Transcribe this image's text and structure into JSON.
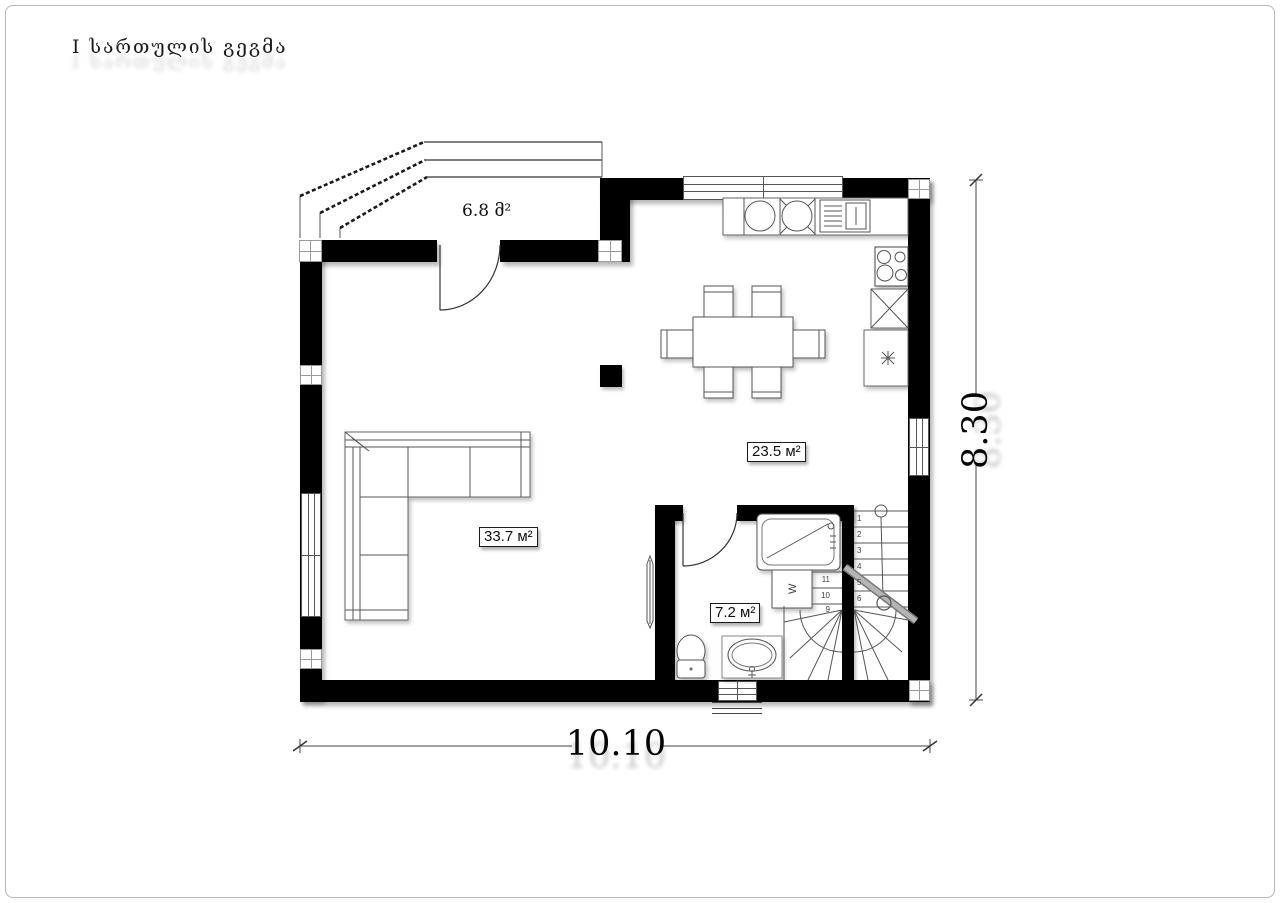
{
  "title": "I სართულის გეგმა",
  "rooms": {
    "porch": {
      "label": "6.8 მ²"
    },
    "living": {
      "label": "33.7 м²"
    },
    "kitchen_dining": {
      "label": "23.5 м²"
    },
    "bathroom": {
      "label": "7.2 м²"
    }
  },
  "dimensions": {
    "total_width": "10.10",
    "total_height": "8.30"
  },
  "stairs": {
    "down_flight_treads": [
      "1",
      "2",
      "3",
      "4",
      "5",
      "6"
    ],
    "upper_flight_treads": [
      "11",
      "10",
      "9"
    ]
  },
  "fixtures": {
    "washer_label": "W"
  },
  "colors": {
    "wall": "#000000",
    "line": "#555555",
    "paper": "#ffffff"
  }
}
